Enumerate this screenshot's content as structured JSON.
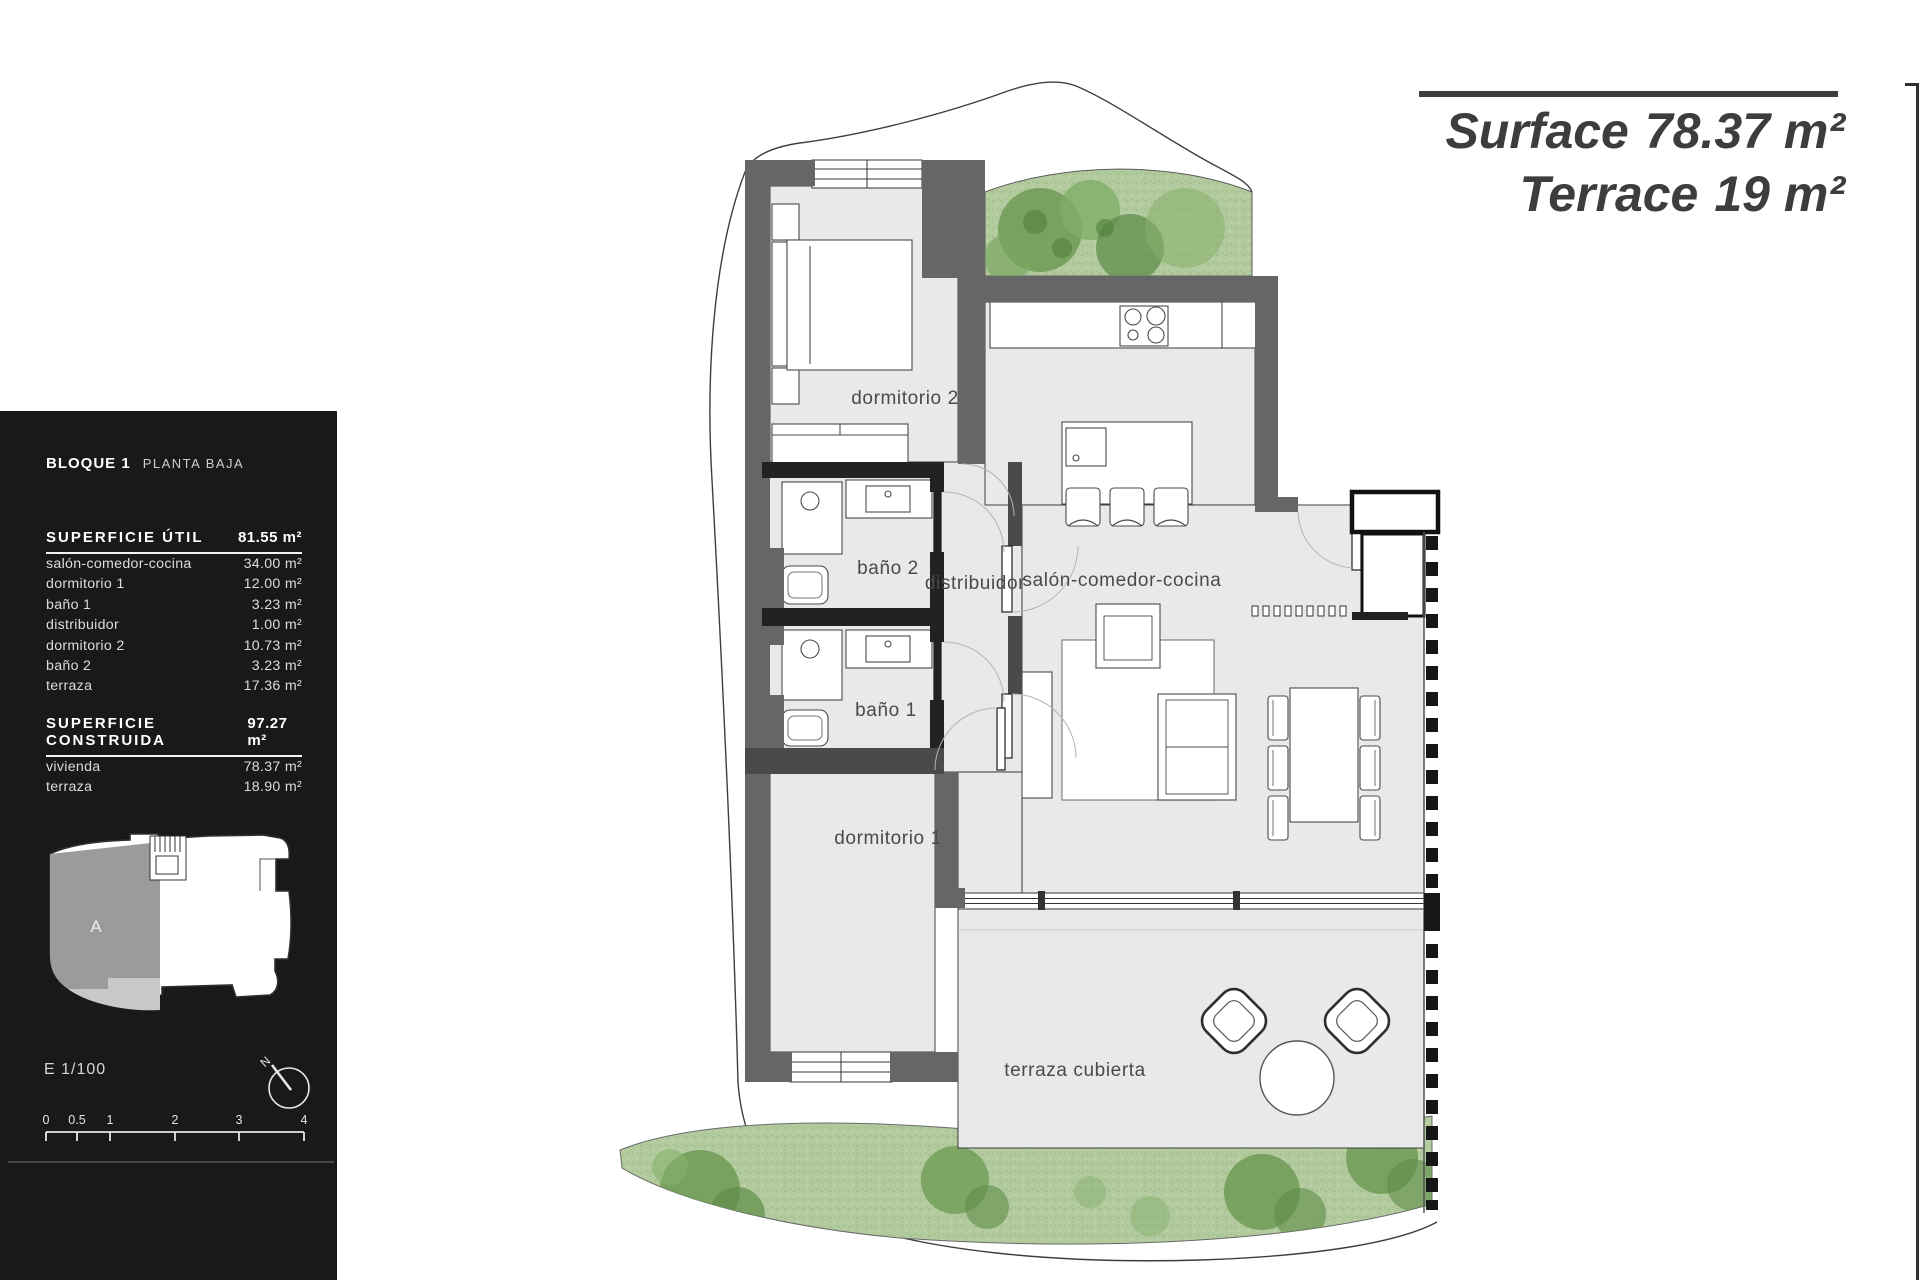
{
  "title": {
    "surface_label": "Surface",
    "surface_value": "78.37 m²",
    "terrace_label": "Terrace",
    "terrace_value": "19 m²"
  },
  "sidebar": {
    "block_title": "BLOQUE 1",
    "block_subtitle": "PLANTA BAJA",
    "util": {
      "heading": "SUPERFICIE ÚTIL",
      "total": "81.55 m²",
      "rows": [
        {
          "label": "salón-comedor-cocina",
          "value": "34.00 m²"
        },
        {
          "label": "dormitorio 1",
          "value": "12.00 m²"
        },
        {
          "label": "baño 1",
          "value": "3.23 m²"
        },
        {
          "label": "distribuidor",
          "value": "1.00 m²"
        },
        {
          "label": "dormitorio 2",
          "value": "10.73 m²"
        },
        {
          "label": "baño 2",
          "value": "3.23 m²"
        },
        {
          "label": "terraza",
          "value": "17.36 m²"
        }
      ]
    },
    "construida": {
      "heading": "SUPERFICIE CONSTRUIDA",
      "total": "97.27 m²",
      "rows": [
        {
          "label": "vivienda",
          "value": "78.37 m²"
        },
        {
          "label": "terraza",
          "value": "18.90 m²"
        }
      ]
    },
    "keyplan_label": "A",
    "scale_text": "E 1/100",
    "compass_n": "N",
    "scalebar_labels": [
      "0",
      "0.5",
      "1",
      "2",
      "3",
      "4"
    ]
  },
  "plan": {
    "rooms": {
      "dormitorio2": "dormitorio 2",
      "bano2": "baño 2",
      "distribuidor": "distribuidor",
      "salon": "salón-comedor-cocina",
      "bano1": "baño 1",
      "dormitorio1": "dormitorio 1",
      "terraza": "terraza cubierta"
    }
  },
  "colors": {
    "wall_gray": "#666666",
    "wall_dark": "#222222",
    "floor": "#e9e9ec",
    "grass": "#b2cb9e",
    "tree": "#6f9b55",
    "accent_text": "#3d3d3d",
    "sidebar_bg": "#191919"
  }
}
